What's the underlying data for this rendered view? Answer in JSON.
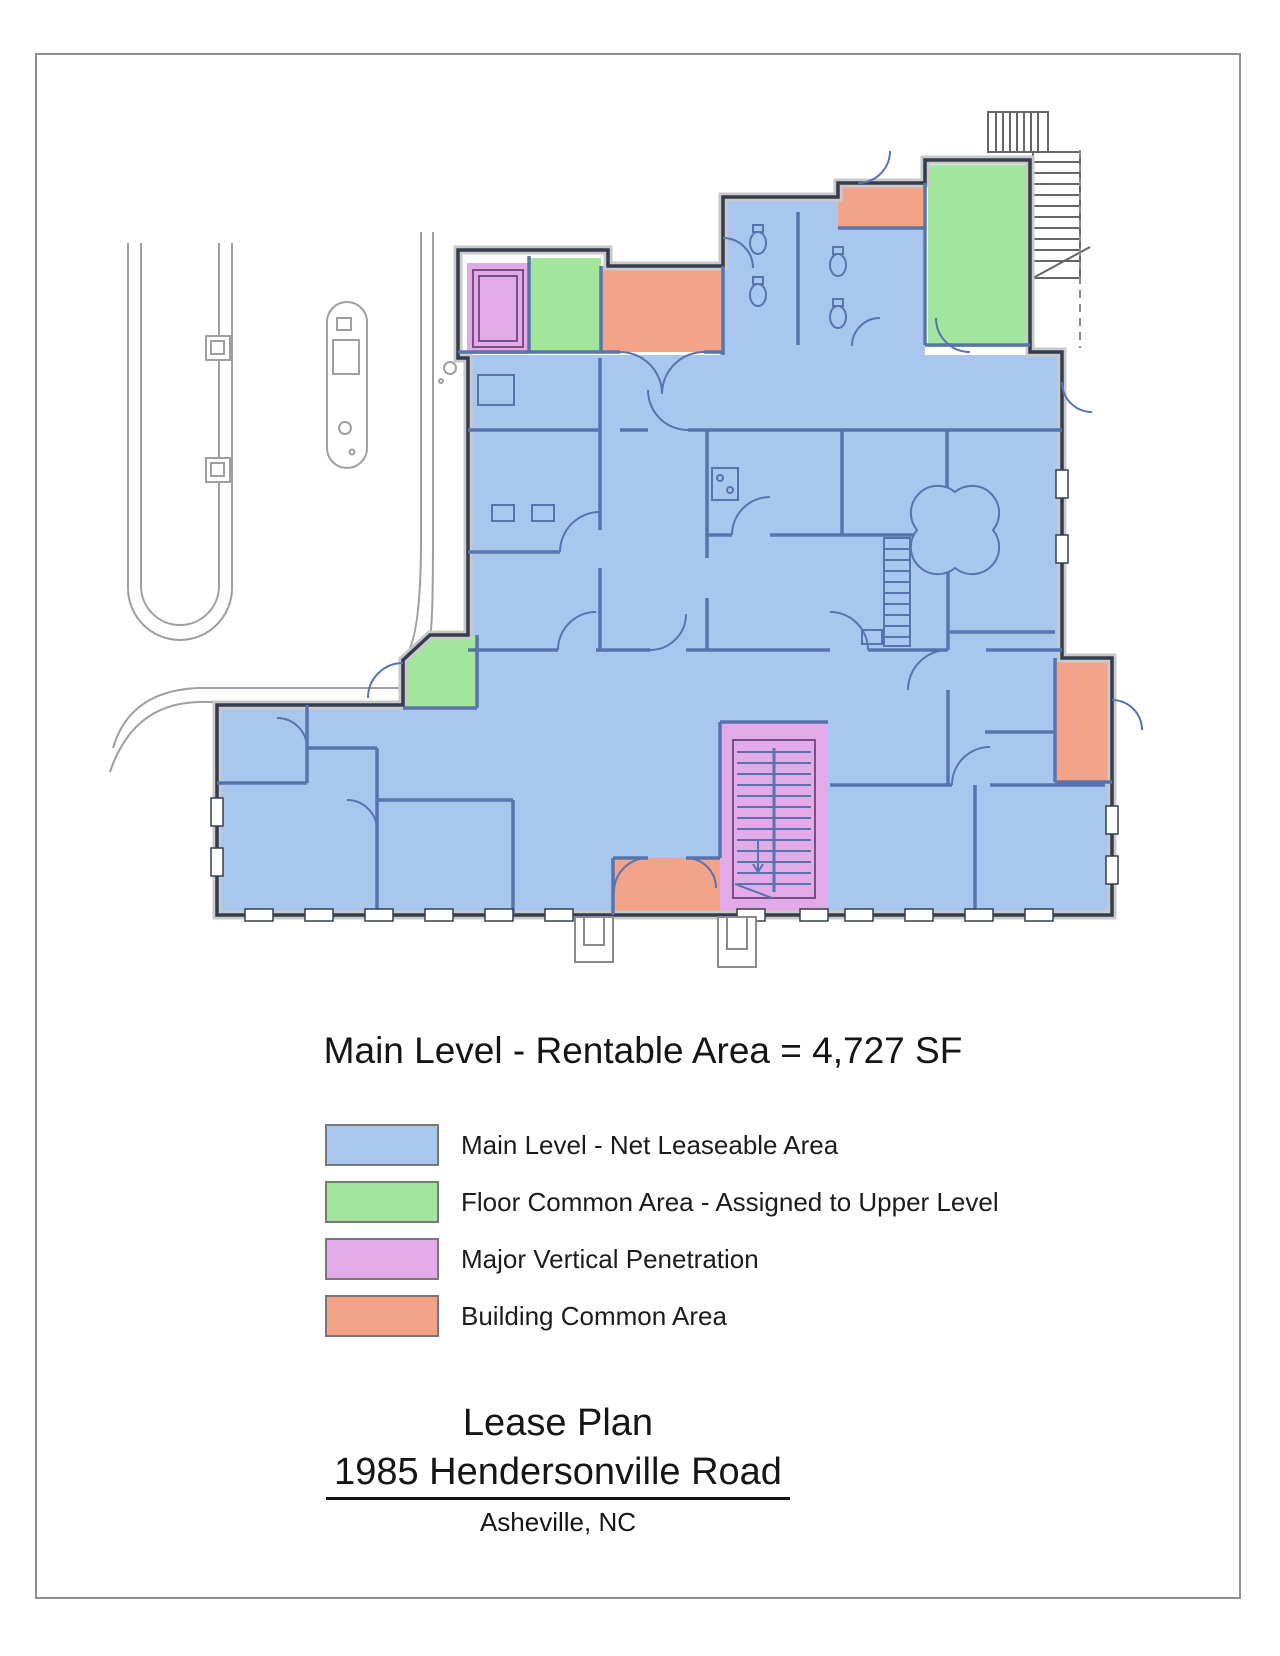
{
  "document": {
    "title": "Main Level - Rentable Area = 4,727 SF",
    "footer": {
      "line1": "Lease Plan",
      "line2": "1985 Hendersonville Road",
      "line3": "Asheville, NC"
    }
  },
  "legend": {
    "items": [
      {
        "id": "net-leaseable",
        "label": "Main Level - Net Leaseable Area",
        "color": "#a9c6ef"
      },
      {
        "id": "floor-common",
        "label": "Floor Common Area - Assigned to Upper Level",
        "color": "#a2e59d"
      },
      {
        "id": "vertical-penetration",
        "label": "Major Vertical Penetration",
        "color": "#e2abe8"
      },
      {
        "id": "building-common",
        "label": "Building Common Area",
        "color": "#f3a388"
      }
    ]
  },
  "plan": {
    "level_name": "Main Level",
    "rentable_area_sf": "4,727",
    "colors": {
      "net_leaseable": "#a9c6ef",
      "floor_common": "#a2e59d",
      "vertical_penetration": "#e2abe8",
      "building_common": "#f3a388",
      "wall": "#343d4e",
      "wall_interior": "#5874ad",
      "stair_accent": "#7a4f86",
      "site": "#9f9f9f"
    }
  }
}
